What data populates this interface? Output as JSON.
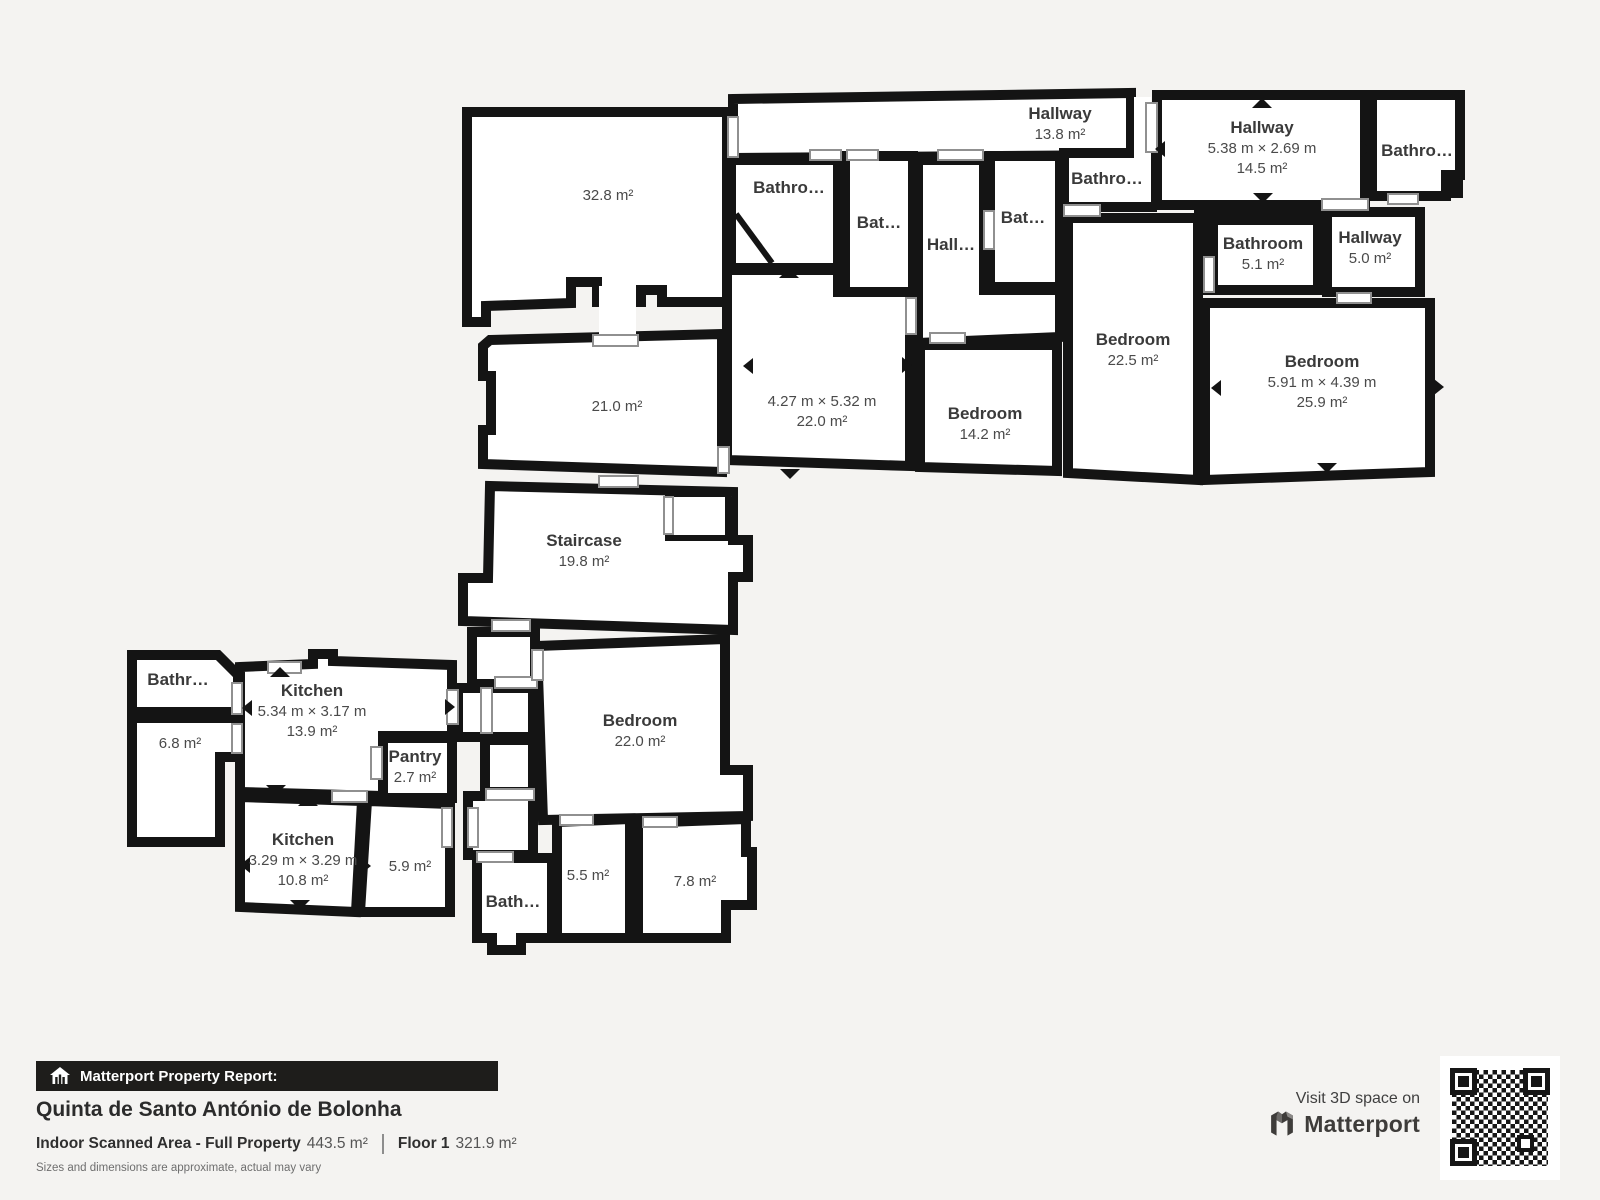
{
  "colors": {
    "wall": "#141414",
    "background": "#f4f3f1",
    "room_fill": "#ffffff",
    "door_outline": "#909090",
    "label_text": "#3a3a3a",
    "footer_bar": "#1e1d1b"
  },
  "floor_plan": {
    "rooms": [
      {
        "id": "hallway-13-8",
        "name": "Hallway",
        "area": "13.8 m²"
      },
      {
        "id": "hallway-14-5",
        "name": "Hallway",
        "dims": "5.38 m × 2.69 m",
        "area": "14.5 m²"
      },
      {
        "id": "bathroom-top-right",
        "name": "Bathro…"
      },
      {
        "id": "bathroom-a",
        "name": "Bathro…"
      },
      {
        "id": "bathroom-b",
        "name": "Bat…"
      },
      {
        "id": "hall-small",
        "name": "Hall…"
      },
      {
        "id": "bathroom-c",
        "name": "Bat…"
      },
      {
        "id": "bathroom-d",
        "name": "Bathro…"
      },
      {
        "id": "bathroom-5-1",
        "name": "Bathroom",
        "area": "5.1 m²"
      },
      {
        "id": "hallway-5-0",
        "name": "Hallway",
        "area": "5.0 m²"
      },
      {
        "id": "room-32-8",
        "area": "32.8 m²"
      },
      {
        "id": "room-21-0",
        "area": "21.0 m²"
      },
      {
        "id": "room-22-0",
        "dims": "4.27 m × 5.32 m",
        "area": "22.0 m²"
      },
      {
        "id": "bedroom-14-2",
        "name": "Bedroom",
        "area": "14.2 m²"
      },
      {
        "id": "bedroom-22-5",
        "name": "Bedroom",
        "area": "22.5 m²"
      },
      {
        "id": "bedroom-25-9",
        "name": "Bedroom",
        "dims": "5.91 m × 4.39 m",
        "area": "25.9 m²"
      },
      {
        "id": "staircase",
        "name": "Staircase",
        "area": "19.8 m²"
      },
      {
        "id": "bathroom-e",
        "name": "Bathr…"
      },
      {
        "id": "room-6-8",
        "area": "6.8 m²"
      },
      {
        "id": "kitchen-13-9",
        "name": "Kitchen",
        "dims": "5.34 m × 3.17 m",
        "area": "13.9 m²"
      },
      {
        "id": "pantry",
        "name": "Pantry",
        "area": "2.7 m²"
      },
      {
        "id": "kitchen-10-8",
        "name": "Kitchen",
        "dims": "3.29 m × 3.29 m",
        "area": "10.8 m²"
      },
      {
        "id": "room-5-9",
        "area": "5.9 m²"
      },
      {
        "id": "bathroom-f",
        "name": "Bath…"
      },
      {
        "id": "room-5-5",
        "area": "5.5 m²"
      },
      {
        "id": "room-7-8",
        "area": "7.8 m²"
      },
      {
        "id": "bedroom-22-0",
        "name": "Bedroom",
        "area": "22.0 m²"
      }
    ]
  },
  "report": {
    "bar_label": "Matterport Property Report:",
    "property_title": "Quinta de Santo António de Bolonha",
    "scanned_area_label": "Indoor Scanned Area - Full Property",
    "scanned_area_value": "443.5 m²",
    "floor_label": "Floor 1",
    "floor_area_value": "321.9 m²",
    "disclaimer": "Sizes and dimensions are approximate, actual may vary"
  },
  "branding": {
    "visit_text": "Visit 3D space on",
    "brand_name": "Matterport"
  }
}
